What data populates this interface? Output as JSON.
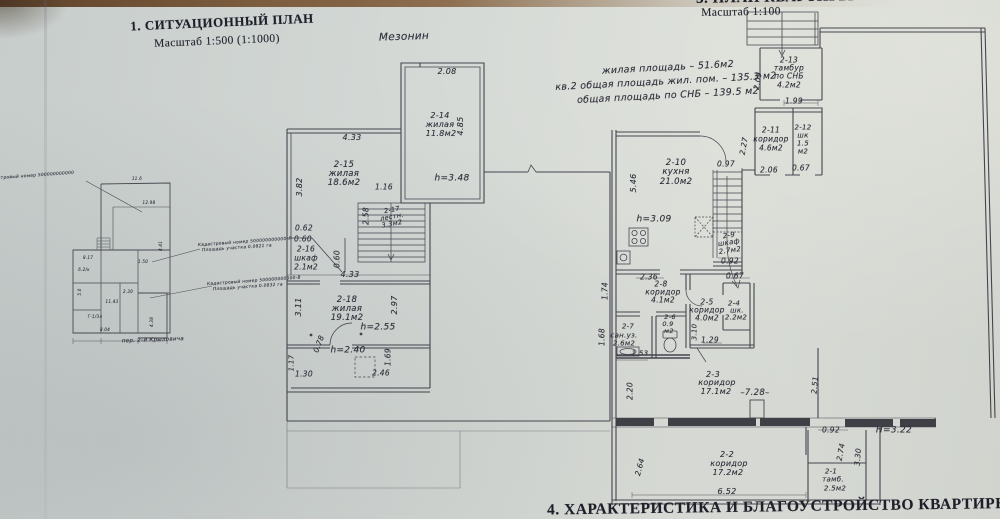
{
  "colors": {
    "paper": "#d2d6d3",
    "ink": "#2c2c36",
    "photo_edge": "#7a5a3b"
  },
  "plans": {
    "site": {
      "labels": [
        {
          "n": "site-plan-title",
          "t": "1. СИТУАЦИОННЫЙ ПЛАН",
          "x": 222,
          "y": 22,
          "s": 13,
          "f": "pb",
          "r": -2.5
        },
        {
          "n": "site-plan-scale",
          "t": "Масштаб 1:500 (1:1000)",
          "x": 217,
          "y": 42,
          "s": 11.5,
          "f": "p",
          "r": -2.5
        },
        {
          "n": "cadastral-annotation-0",
          "t": "Кадастровый номер 500000000000",
          "x": 30,
          "y": 177,
          "s": 4.3,
          "r": -4
        },
        {
          "n": "cadastral-annotation-1a",
          "t": "Кадастровый номер 500000000000-Л",
          "x": 245,
          "y": 243,
          "s": 4.3,
          "r": -4
        },
        {
          "n": "cadastral-annotation-1b",
          "t": "Площадь участка 0.0821 га",
          "x": 237,
          "y": 249,
          "s": 4.3,
          "r": -4
        },
        {
          "n": "cadastral-annotation-2a",
          "t": "Кадастровый номер 500000000000-В",
          "x": 254,
          "y": 282,
          "s": 4.3,
          "r": -4
        },
        {
          "n": "cadastral-annotation-2b",
          "t": "Площадь участка 0.0832 га",
          "x": 248,
          "y": 288,
          "s": 4.3,
          "r": -4
        },
        {
          "n": "street-label",
          "t": "пер. 2-й Крыловича",
          "x": 153,
          "y": 341,
          "s": 5.5,
          "r": -2
        },
        {
          "t": "11.6",
          "x": 137,
          "y": 179,
          "s": 4
        },
        {
          "t": "12.98",
          "x": 149,
          "y": 203,
          "s": 4
        },
        {
          "t": "4.41",
          "x": 161,
          "y": 246,
          "s": 4,
          "r": -90
        },
        {
          "t": "8.17",
          "x": 88,
          "y": 258,
          "s": 4
        },
        {
          "t": "6.2/к",
          "x": 84,
          "y": 270,
          "s": 4
        },
        {
          "t": "5.0",
          "x": 80,
          "y": 292,
          "s": 4,
          "r": -90
        },
        {
          "t": "1.50",
          "x": 143,
          "y": 262,
          "s": 4
        },
        {
          "t": "2.30",
          "x": 128,
          "y": 292,
          "s": 4
        },
        {
          "t": "11.43",
          "x": 112,
          "y": 302,
          "s": 4
        },
        {
          "t": "Г-1/Зл",
          "x": 95,
          "y": 317,
          "s": 4
        },
        {
          "t": "8.04",
          "x": 105,
          "y": 330,
          "s": 4
        },
        {
          "t": "4.38",
          "x": 152,
          "y": 322,
          "s": 4,
          "r": -90
        }
      ]
    },
    "mezzanine": {
      "labels": [
        {
          "n": "mezzanine-title",
          "t": "Мезонин",
          "x": 404,
          "y": 37,
          "s": 10.5,
          "r": -2
        },
        {
          "t": "2.08",
          "x": 447,
          "y": 72,
          "s": 8
        },
        {
          "n": "room-2-14-number",
          "t": "2-14",
          "x": 440,
          "y": 116,
          "s": 8
        },
        {
          "n": "room-2-14-type",
          "t": "жилая",
          "x": 440,
          "y": 125,
          "s": 8
        },
        {
          "n": "room-2-14-area",
          "t": "11.8м2",
          "x": 441,
          "y": 134,
          "s": 8
        },
        {
          "t": "4.85",
          "x": 461,
          "y": 126,
          "s": 8,
          "r": -90
        },
        {
          "n": "height-mark-2-14",
          "t": "h=3.48",
          "x": 452,
          "y": 179,
          "s": 9
        },
        {
          "t": "4.33",
          "x": 352,
          "y": 138,
          "s": 8
        },
        {
          "t": "3.82",
          "x": 300,
          "y": 187,
          "s": 8,
          "r": -90
        },
        {
          "n": "room-2-15-number",
          "t": "2-15",
          "x": 344,
          "y": 165,
          "s": 8.5
        },
        {
          "n": "room-2-15-type",
          "t": "жилая",
          "x": 344,
          "y": 174,
          "s": 8.5
        },
        {
          "n": "room-2-15-area",
          "t": "18.6м2",
          "x": 344,
          "y": 183,
          "s": 8.5
        },
        {
          "t": "1.16",
          "x": 384,
          "y": 187,
          "s": 7.5
        },
        {
          "t": "2.58",
          "x": 366,
          "y": 216,
          "s": 7.5,
          "r": -90
        },
        {
          "n": "room-2-17-number",
          "t": "2-17",
          "x": 392,
          "y": 210,
          "s": 6.5,
          "r": -10
        },
        {
          "n": "room-2-17-type",
          "t": "лестн.",
          "x": 392,
          "y": 217,
          "s": 6.5,
          "r": -10
        },
        {
          "n": "room-2-17-area",
          "t": "3.3м2",
          "x": 392,
          "y": 224,
          "s": 6.5,
          "r": -10
        },
        {
          "t": "0.62",
          "x": 304,
          "y": 228,
          "s": 7.5
        },
        {
          "t": "0.60",
          "x": 303,
          "y": 239,
          "s": 7.5
        },
        {
          "n": "room-2-16-number",
          "t": "2-16",
          "x": 306,
          "y": 249,
          "s": 7.5
        },
        {
          "n": "room-2-16-type",
          "t": "шкаф",
          "x": 306,
          "y": 258,
          "s": 7.5
        },
        {
          "n": "room-2-16-area",
          "t": "2.1м2",
          "x": 306,
          "y": 267,
          "s": 7.5
        },
        {
          "t": "0.60",
          "x": 337,
          "y": 259,
          "s": 7.5,
          "r": -90
        },
        {
          "t": "4.33",
          "x": 350,
          "y": 275,
          "s": 8
        },
        {
          "t": "3.11",
          "x": 299,
          "y": 307,
          "s": 8,
          "r": -90
        },
        {
          "n": "room-2-18-number",
          "t": "2-18",
          "x": 347,
          "y": 300,
          "s": 8.5
        },
        {
          "n": "room-2-18-type",
          "t": "жилая",
          "x": 347,
          "y": 309,
          "s": 8.5
        },
        {
          "n": "room-2-18-area",
          "t": "19.1м2",
          "x": 347,
          "y": 318,
          "s": 8.5
        },
        {
          "t": "2.97",
          "x": 395,
          "y": 305,
          "s": 8,
          "r": -90
        },
        {
          "n": "height-mark-2-18",
          "t": "h=2.55",
          "x": 378,
          "y": 328,
          "s": 9
        },
        {
          "t": "0.78",
          "x": 319,
          "y": 344,
          "s": 7.5,
          "r": -70
        },
        {
          "n": "height-mark-annex",
          "t": "h=2.40",
          "x": 348,
          "y": 351,
          "s": 9
        },
        {
          "t": "1.69",
          "x": 388,
          "y": 357,
          "s": 7.5,
          "r": -90
        },
        {
          "t": "1.30",
          "x": 304,
          "y": 374,
          "s": 7.5
        },
        {
          "t": "2.46",
          "x": 381,
          "y": 373,
          "s": 7.5
        },
        {
          "t": "1.17",
          "x": 292,
          "y": 363,
          "s": 7,
          "r": -90
        }
      ]
    },
    "apartment": {
      "labels": [
        {
          "n": "apartment-plan-title",
          "t": "3. ПЛАН КВАРТИРЫ",
          "x": 775,
          "y": -2,
          "s": 15,
          "f": "pb",
          "r": -1
        },
        {
          "n": "apartment-plan-scale",
          "t": "Масштаб 1:100",
          "x": 741,
          "y": 13,
          "s": 11.5,
          "f": "p",
          "r": -1
        },
        {
          "n": "area-summary-line1",
          "t": "жилая площадь – 51.6м2",
          "x": 668,
          "y": 68,
          "s": 9.5,
          "r": -3
        },
        {
          "n": "area-summary-line2",
          "t": "кв.2 общая площадь жил. пом. – 135.3 м2",
          "x": 666,
          "y": 82,
          "s": 9.5,
          "r": -3
        },
        {
          "n": "area-summary-line3",
          "t": "общая площадь по СНБ – 139.5 м2",
          "x": 668,
          "y": 96,
          "s": 9.5,
          "r": -3
        },
        {
          "t": "2.09",
          "x": 758,
          "y": 81,
          "s": 7.5,
          "r": -80
        },
        {
          "n": "room-2-13-number",
          "t": "2-13",
          "x": 789,
          "y": 60,
          "s": 7.5
        },
        {
          "n": "room-2-13-type",
          "t": "тамбур",
          "x": 789,
          "y": 68,
          "s": 7.5
        },
        {
          "n": "room-2-13-type2",
          "t": "по СНБ",
          "x": 789,
          "y": 76,
          "s": 7.5
        },
        {
          "n": "room-2-13-area",
          "t": "4.2м2",
          "x": 789,
          "y": 85,
          "s": 7.5
        },
        {
          "t": "1.99",
          "x": 794,
          "y": 101,
          "s": 7.5
        },
        {
          "n": "room-2-11-number",
          "t": "2-11",
          "x": 771,
          "y": 130,
          "s": 7.5
        },
        {
          "n": "room-2-11-type",
          "t": "коридор",
          "x": 771,
          "y": 139,
          "s": 7.5
        },
        {
          "n": "room-2-11-area",
          "t": "4.6м2",
          "x": 771,
          "y": 148,
          "s": 7.5
        },
        {
          "n": "room-2-12-number",
          "t": "2-12",
          "x": 803,
          "y": 128,
          "s": 7
        },
        {
          "n": "room-2-12-type",
          "t": "шк",
          "x": 803,
          "y": 136,
          "s": 7
        },
        {
          "n": "room-2-12-area1",
          "t": "1.5",
          "x": 803,
          "y": 144,
          "s": 7
        },
        {
          "n": "room-2-12-area2",
          "t": "м2",
          "x": 803,
          "y": 152,
          "s": 7
        },
        {
          "t": "2.27",
          "x": 744,
          "y": 146,
          "s": 7.5,
          "r": -80
        },
        {
          "t": "2.06",
          "x": 769,
          "y": 170,
          "s": 7.5
        },
        {
          "t": "0.67",
          "x": 801,
          "y": 168,
          "s": 7.5
        },
        {
          "t": "0.97",
          "x": 726,
          "y": 164,
          "s": 7.5
        },
        {
          "t": "5.46",
          "x": 634,
          "y": 183,
          "s": 8,
          "r": -90
        },
        {
          "n": "room-2-10-number",
          "t": "2-10",
          "x": 676,
          "y": 163,
          "s": 8.5
        },
        {
          "n": "room-2-10-type",
          "t": "кухня",
          "x": 676,
          "y": 172,
          "s": 8.5
        },
        {
          "n": "room-2-10-area",
          "t": "21.0м2",
          "x": 676,
          "y": 182,
          "s": 8.5
        },
        {
          "n": "height-mark-kitchen",
          "t": "h=3.09",
          "x": 654,
          "y": 220,
          "s": 9
        },
        {
          "n": "room-2-9-number",
          "t": "2-9",
          "x": 729,
          "y": 236,
          "s": 7,
          "r": -8
        },
        {
          "n": "room-2-9-type",
          "t": "шкаф",
          "x": 729,
          "y": 243,
          "s": 7,
          "r": -8
        },
        {
          "n": "room-2-9-area",
          "t": "2.7м2",
          "x": 730,
          "y": 251,
          "s": 7,
          "r": -8
        },
        {
          "t": "0.92",
          "x": 730,
          "y": 261,
          "s": 7.5
        },
        {
          "t": "2.36",
          "x": 649,
          "y": 277,
          "s": 7.5
        },
        {
          "t": "0.67",
          "x": 735,
          "y": 276,
          "s": 7.5
        },
        {
          "t": "1.74",
          "x": 605,
          "y": 291,
          "s": 7.5,
          "r": -90
        },
        {
          "n": "room-2-8-number",
          "t": "2-8",
          "x": 661,
          "y": 284,
          "s": 7.5
        },
        {
          "n": "room-2-8-type",
          "t": "коридор",
          "x": 663,
          "y": 292,
          "s": 7.5
        },
        {
          "n": "room-2-8-area",
          "t": "4.1м2",
          "x": 663,
          "y": 300,
          "s": 7.5
        },
        {
          "n": "room-2-5-number",
          "t": "2-5",
          "x": 707,
          "y": 302,
          "s": 7.5
        },
        {
          "n": "room-2-5-type",
          "t": "коридор",
          "x": 707,
          "y": 310,
          "s": 7.5
        },
        {
          "n": "room-2-5-area",
          "t": "4.0м2",
          "x": 707,
          "y": 318,
          "s": 7.5
        },
        {
          "n": "room-2-4-number",
          "t": "2-4",
          "x": 734,
          "y": 304,
          "s": 7
        },
        {
          "n": "room-2-4-type",
          "t": "шк.",
          "x": 737,
          "y": 311,
          "s": 7
        },
        {
          "n": "room-2-4-area",
          "t": "2.2м2",
          "x": 736,
          "y": 318,
          "s": 7
        },
        {
          "t": "1.68",
          "x": 602,
          "y": 337,
          "s": 7.5,
          "r": -90
        },
        {
          "n": "room-2-7-number",
          "t": "2-7",
          "x": 628,
          "y": 327,
          "s": 7
        },
        {
          "n": "room-2-7-type",
          "t": "сан.уз.",
          "x": 624,
          "y": 336,
          "s": 7
        },
        {
          "n": "room-2-7-area",
          "t": "2.6м2",
          "x": 624,
          "y": 344,
          "s": 7
        },
        {
          "n": "room-2-6-number",
          "t": "2-6",
          "x": 670,
          "y": 317,
          "s": 6.5
        },
        {
          "n": "room-2-6-area1",
          "t": "0.9",
          "x": 668,
          "y": 324,
          "s": 6.5
        },
        {
          "n": "room-2-6-area2",
          "t": "м2",
          "x": 669,
          "y": 331,
          "s": 6.5
        },
        {
          "t": "3.10",
          "x": 695,
          "y": 332,
          "s": 7,
          "r": -90
        },
        {
          "t": "1.29",
          "x": 710,
          "y": 340,
          "s": 7.5
        },
        {
          "t": "1.53",
          "x": 640,
          "y": 354,
          "s": 7
        },
        {
          "n": "room-2-3-number",
          "t": "2-3",
          "x": 713,
          "y": 375,
          "s": 8
        },
        {
          "n": "room-2-3-type",
          "t": "коридор",
          "x": 717,
          "y": 383,
          "s": 8
        },
        {
          "n": "room-2-3-area",
          "t": "17.1м2",
          "x": 716,
          "y": 392,
          "s": 8
        },
        {
          "n": "level-mark",
          "t": "–7.28–",
          "x": 755,
          "y": 393,
          "s": 8.5
        },
        {
          "t": "2.20",
          "x": 630,
          "y": 391,
          "s": 7.5,
          "r": -90
        },
        {
          "t": "2.51",
          "x": 815,
          "y": 385,
          "s": 7.5,
          "r": -85
        },
        {
          "t": "0.92",
          "x": 831,
          "y": 430,
          "s": 7.5
        },
        {
          "n": "room-2-2-number",
          "t": "2-2",
          "x": 727,
          "y": 455,
          "s": 8
        },
        {
          "n": "room-2-2-type",
          "t": "коридор",
          "x": 729,
          "y": 464,
          "s": 8
        },
        {
          "n": "room-2-2-area",
          "t": "17.2м2",
          "x": 728,
          "y": 473,
          "s": 8
        },
        {
          "t": "2.64",
          "x": 640,
          "y": 467,
          "s": 7.5,
          "r": -75
        },
        {
          "t": "6.52",
          "x": 727,
          "y": 492,
          "s": 8
        },
        {
          "n": "room-2-1-number",
          "t": "2-1",
          "x": 831,
          "y": 472,
          "s": 7
        },
        {
          "n": "room-2-1-type",
          "t": "тамб.",
          "x": 833,
          "y": 480,
          "s": 7
        },
        {
          "n": "room-2-1-area",
          "t": "2.5м2",
          "x": 835,
          "y": 489,
          "s": 7
        },
        {
          "t": "2.74",
          "x": 841,
          "y": 452,
          "s": 7.5,
          "r": -80
        },
        {
          "t": "3.30",
          "x": 858,
          "y": 457,
          "s": 7.5,
          "r": -85
        },
        {
          "n": "height-mark-lower",
          "t": "Н=3.22",
          "x": 894,
          "y": 431,
          "s": 9
        }
      ]
    },
    "footer": {
      "labels": [
        {
          "n": "characteristics-title",
          "t": "4. ХАРАКТЕРИСТИКА И БЛАГОУСТРОЙСТВО КВАРТИРЫ",
          "x": 779,
          "y": 507,
          "s": 15.5,
          "f": "pb",
          "r": -0.8
        }
      ]
    }
  }
}
